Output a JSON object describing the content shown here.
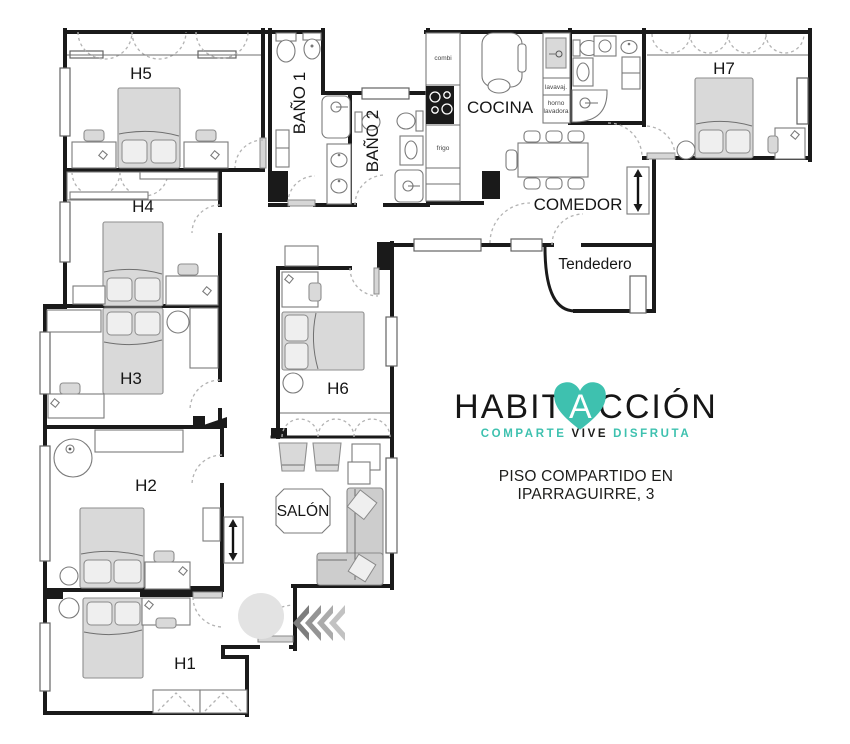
{
  "floorplan": {
    "rooms": {
      "h1": "H1",
      "h2": "H2",
      "h3": "H3",
      "h4": "H4",
      "h5": "H5",
      "h6": "H6",
      "h7": "H7",
      "bano1": "BAÑO 1",
      "bano2": "BAÑO 2",
      "cocina": "COCINA",
      "comedor": "COMEDOR",
      "tendedero": "Tendedero",
      "salon": "SALÓN"
    },
    "appliances": {
      "combi": "combi",
      "frigo": "frigo",
      "lavavajillas": "lavavaj.",
      "horno": "horno",
      "lavadora": "lavadora"
    }
  },
  "branding": {
    "logo_part1": "HABIT",
    "logo_part2": "A",
    "logo_part3": "CCIÓN",
    "tagline_part1": "COMPARTE",
    "tagline_part2": "VIVE",
    "tagline_part3": "DISFRUTA",
    "caption": "PISO COMPARTIDO EN IPARRAGUIRRE, 3",
    "accent_color": "#3ec1af"
  }
}
